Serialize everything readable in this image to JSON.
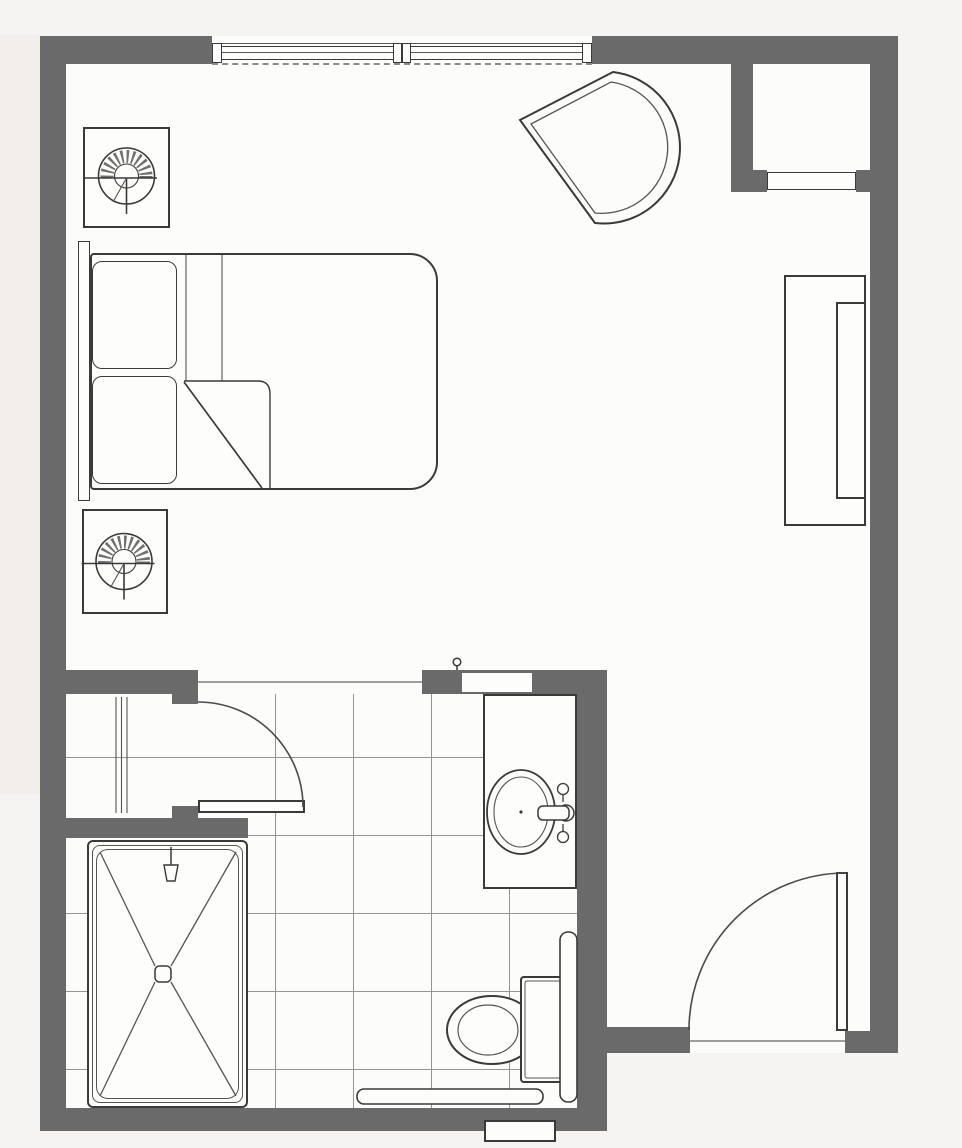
{
  "document": {
    "kind": "architectural-floor-plan",
    "description": "studio-suite-floor-plan-scan",
    "visible_text": []
  },
  "colors": {
    "wall": "#6a6a6a",
    "line": "#3a3a3a",
    "line-soft": "#555555",
    "grid": "#949494",
    "floor": "#fcfcfa",
    "outside": "#f5f4f2",
    "fix": "#fdfdfb",
    "scan": "#eceae7",
    "sill": "#8a8a8a"
  },
  "rooms": [
    {
      "name": "bedroom-living-area"
    },
    {
      "name": "bathroom"
    },
    {
      "name": "entry-vestibule"
    },
    {
      "name": "closet-niche"
    }
  ],
  "fixtures": {
    "bedroom": [
      "window",
      "bed",
      "headboard",
      "pillow",
      "pillow",
      "nightstand-with-lamp",
      "nightstand-with-lamp",
      "curved-lounge-chair",
      "wardrobe-dresser",
      "closet-door-panel"
    ],
    "bathroom": [
      "roll-in-shower",
      "shower-drain",
      "shower-head",
      "vanity-counter",
      "oval-sink",
      "faucet",
      "toilet",
      "toilet-tank",
      "grab-bar-vertical",
      "grab-bar-horizontal",
      "linen-shelving",
      "tile-floor-grid",
      "robe-hook"
    ],
    "doors": [
      "bathroom-swing-door",
      "entry-swing-door"
    ]
  },
  "counts": {
    "windows": 1,
    "swing_doors": 2,
    "rooms": 4
  }
}
